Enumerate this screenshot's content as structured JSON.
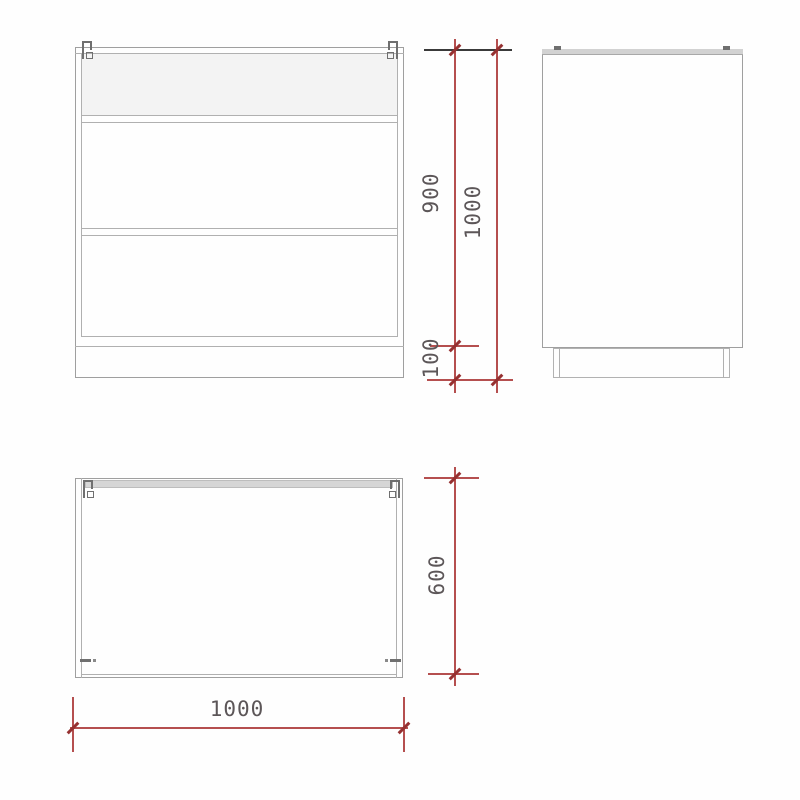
{
  "drawing": {
    "type": "furniture-technical-drawing",
    "views": {
      "front": {
        "name": "front elevation"
      },
      "side": {
        "name": "side elevation"
      },
      "plan": {
        "name": "plan view"
      }
    },
    "dimensions": {
      "front_carcass_height": {
        "value": "900"
      },
      "front_total_height": {
        "value": "1000"
      },
      "plinth_height": {
        "value": "100"
      },
      "plan_depth": {
        "value": "600"
      },
      "plan_width": {
        "value": "1000"
      }
    },
    "colors": {
      "background": "#fefefe",
      "cabinet_line": "#9f9f9f",
      "panel_fill": "#d6d6d6",
      "shade_fill": "#f3f3f3",
      "dimension_line": "#b54f4f",
      "dimension_tick": "#963131",
      "extension_line_black": "#3a3a3a",
      "dimension_text": "#5c5658",
      "hardware_mark": "#6f6f6f"
    }
  }
}
